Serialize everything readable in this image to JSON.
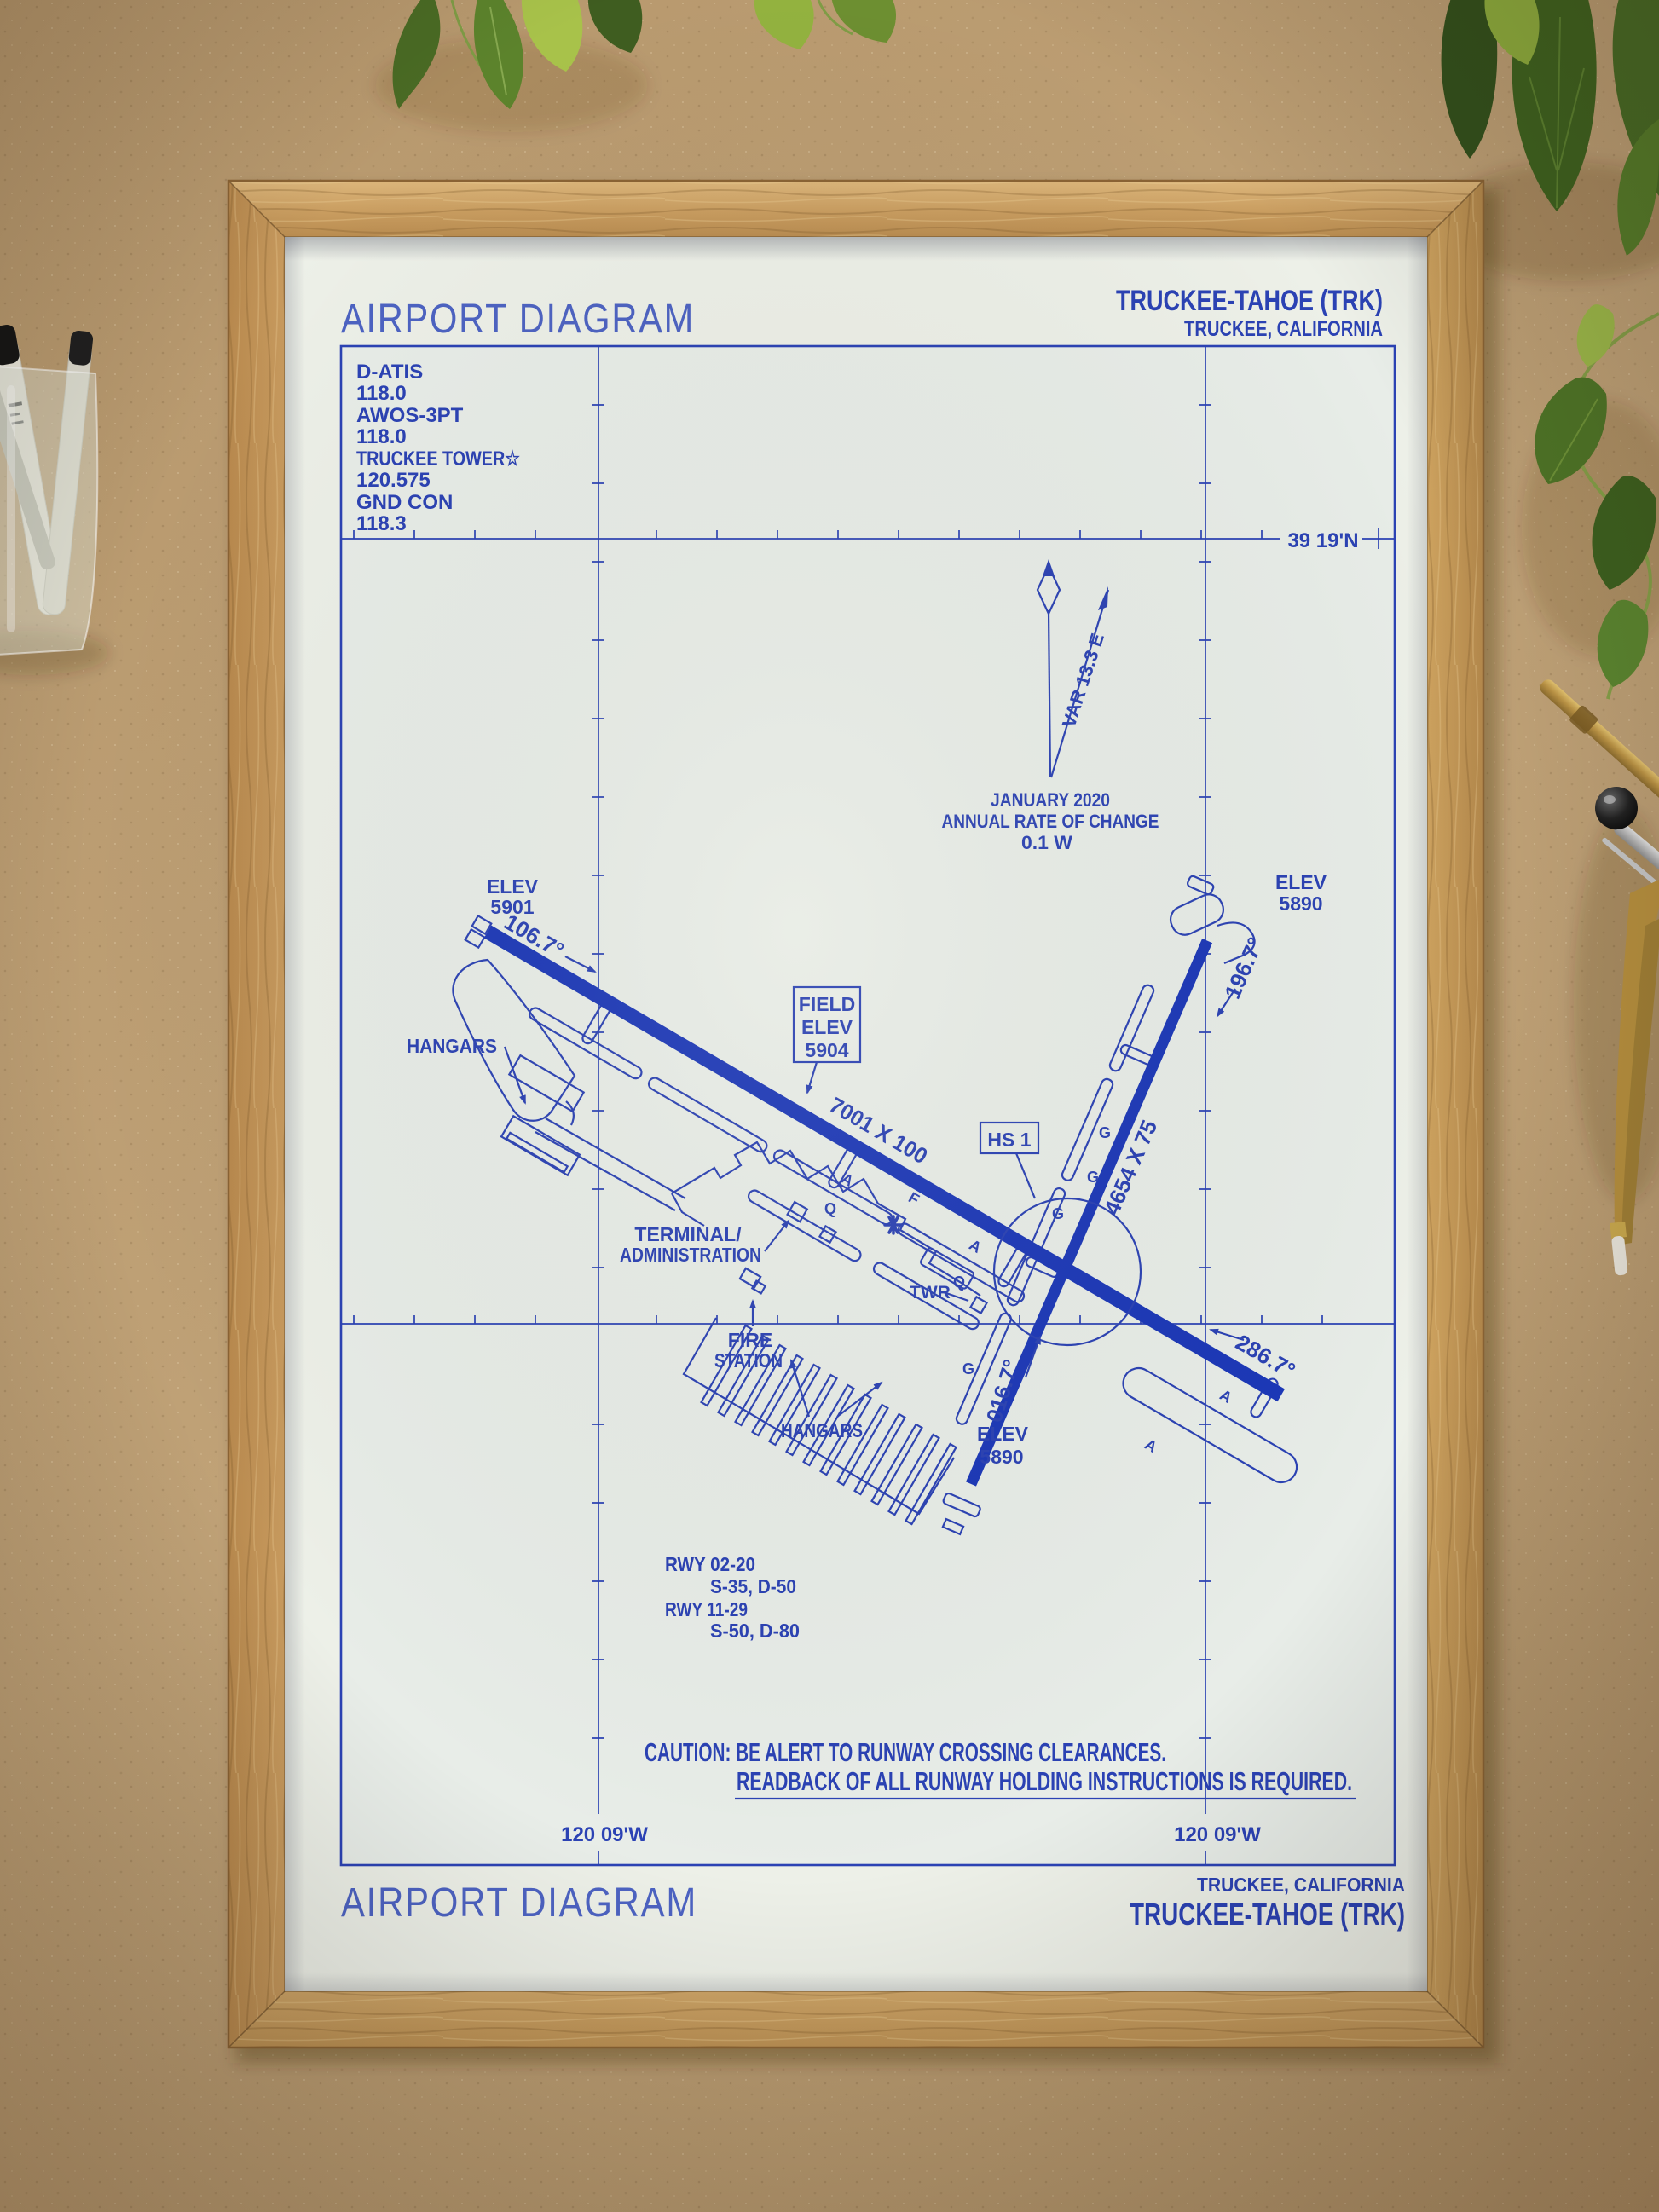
{
  "palette": {
    "ink": "#2b42b4",
    "ink_deep": "#1c38b8",
    "ink_light": "#4d63c2",
    "paper": "#edf0e8",
    "frame_wood": "#c59e63",
    "background": "#bda078",
    "plant_green": "#4a7026"
  },
  "chart": {
    "header": {
      "title": "AIRPORT DIAGRAM",
      "airport": "TRUCKEE-TAHOE (TRK)",
      "city": "TRUCKEE, CALIFORNIA"
    },
    "footer": {
      "title": "AIRPORT DIAGRAM",
      "city": "TRUCKEE, CALIFORNIA",
      "airport": "TRUCKEE-TAHOE (TRK)"
    },
    "frequency_box": {
      "lines": [
        "D-ATIS",
        "118.0",
        "AWOS-3PT",
        "118.0",
        "TRUCKEE TOWER☆",
        "120.575",
        "GND CON",
        "118.3"
      ]
    },
    "graticule": {
      "lat_label": "39 19'N",
      "lon_label_left": "120 09'W",
      "lon_label_right": "120 09'W"
    },
    "magnetic_variation": {
      "var_label": "VAR 13.3 E",
      "date": "JANUARY 2020",
      "rate_line": "ANNUAL RATE OF CHANGE",
      "rate_value": "0.1 W"
    },
    "field_elevation_box": {
      "line1": "FIELD",
      "line2": "ELEV",
      "line3": "5904"
    },
    "hot_spot": {
      "label": "HS 1"
    },
    "runways": {
      "rwy_11_29": {
        "dimensions": "7001 X 100",
        "heading_11": "106.7°",
        "heading_29": "286.7°",
        "elev_rwy11_l1": "ELEV",
        "elev_rwy11_l2": "5901"
      },
      "rwy_02_20": {
        "dimensions": "4654 X 75",
        "heading_02": "016.7°",
        "heading_20": "196.7°",
        "elev_rwy20_l1": "ELEV",
        "elev_rwy20_l2": "5890",
        "elev_rwy02_l1": "ELEV",
        "elev_rwy02_l2": "5890"
      }
    },
    "buildings": {
      "hangars_west": "HANGARS",
      "hangars_south": "HANGARS",
      "terminal_line1": "TERMINAL/",
      "terminal_line2": "ADMINISTRATION",
      "tower": "TWR",
      "fire_line1": "FIRE",
      "fire_line2": "STATION"
    },
    "taxiways": {
      "a": "A",
      "f": "F",
      "q": "Q",
      "g": "G"
    },
    "runway_data_block": {
      "lines": [
        "RWY 02-20",
        "S-35, D-50",
        "RWY 11-29",
        "S-50, D-80"
      ]
    },
    "caution": {
      "line1": "CAUTION: BE ALERT TO RUNWAY CROSSING CLEARANCES.",
      "line2": "READBACK OF ALL RUNWAY HOLDING INSTRUCTIONS IS REQUIRED."
    }
  }
}
